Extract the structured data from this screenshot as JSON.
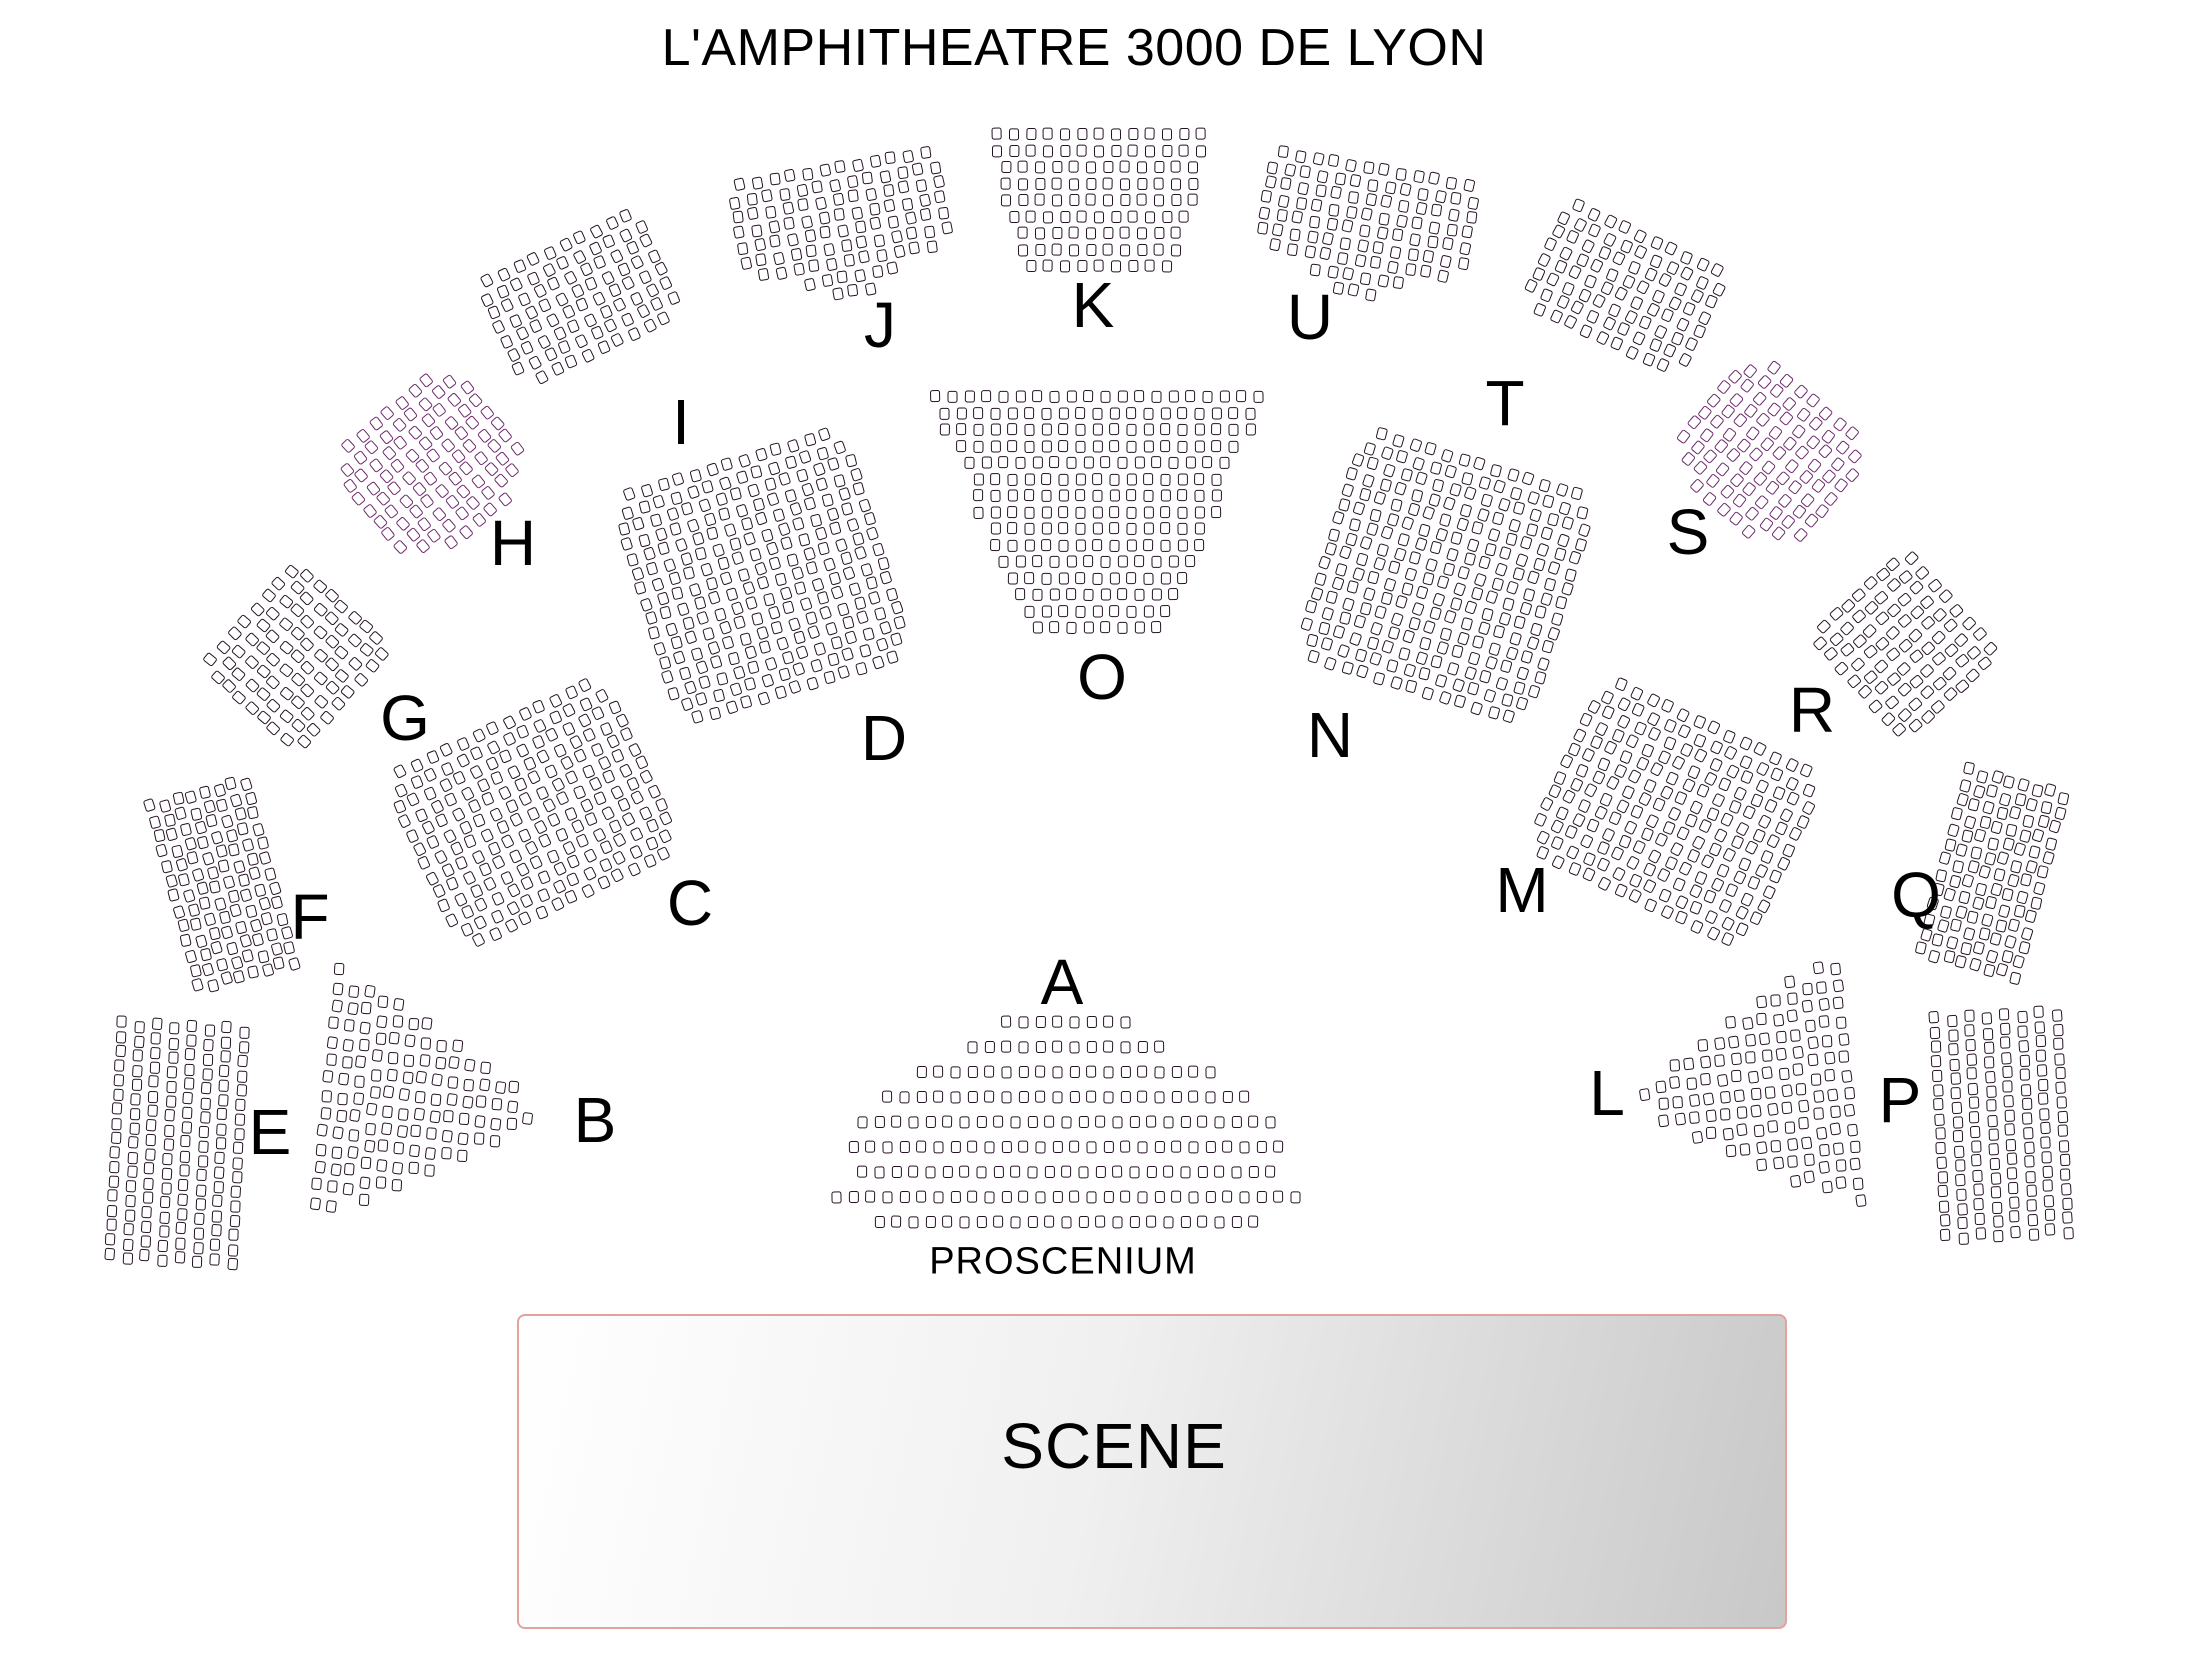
{
  "title": "L'AMPHITHEATRE 3000 DE LYON",
  "title_pos": {
    "x": 1074,
    "y": 18
  },
  "colors": {
    "background": "#ffffff",
    "text": "#000000",
    "seat_fill": "#ffffff",
    "seat_stroke": "#251225",
    "seat_stroke_accent": "#6b286b",
    "stage_border": "#e5a29a",
    "stage_gradient_from": "#ffffff",
    "stage_gradient_to": "#c8c8c8"
  },
  "stage": {
    "label": "SCENE",
    "x": 517,
    "y": 1314,
    "w": 1270,
    "h": 315,
    "label_x": 1114,
    "label_y": 1446
  },
  "proscenium": {
    "label": "PROSCENIUM",
    "x": 1063,
    "y": 1262
  },
  "seat_defaults": {
    "col_gap": 7,
    "row_gap": 3.5
  },
  "sections": [
    {
      "id": "A",
      "label": "A",
      "label_x": 1062,
      "label_y": 982,
      "cx": 1066,
      "cy": 1122,
      "rot": 0,
      "row_gap": 13,
      "jitter": 0.4,
      "rows": [
        8,
        12,
        18,
        22,
        25,
        26,
        25,
        28,
        23
      ]
    },
    {
      "id": "B",
      "label": "B",
      "label_x": 595,
      "label_y": 1120,
      "cx": 428,
      "cy": 1097,
      "rot": 6,
      "col_gap": 5.5,
      "row_gap": 6,
      "stagger": 5,
      "cols": [
        14,
        13,
        12,
        12,
        11,
        10,
        9,
        8,
        7,
        6,
        5,
        4,
        3,
        1
      ]
    },
    {
      "id": "C",
      "label": "C",
      "label_x": 690,
      "label_y": 903,
      "cx": 533,
      "cy": 813,
      "rot": -25,
      "rows": [
        13,
        14,
        15,
        15,
        15,
        15,
        15,
        15,
        15,
        15,
        15,
        14,
        13
      ]
    },
    {
      "id": "D",
      "label": "D",
      "label_x": 884,
      "label_y": 738,
      "cx": 762,
      "cy": 576,
      "rot": -17,
      "rows": [
        13,
        14,
        15,
        15,
        15,
        15,
        15,
        15,
        15,
        15,
        15,
        15,
        15,
        15,
        14,
        13
      ]
    },
    {
      "id": "E",
      "label": "E",
      "label_x": 270,
      "label_y": 1132,
      "cx": 177,
      "cy": 1141,
      "rot": 3,
      "row_gap": 2.5,
      "col_gap": 7.5,
      "stagger": 4,
      "jitter": 0.4,
      "rows": [
        8,
        8,
        8,
        8,
        8,
        8,
        8,
        8,
        8,
        8,
        8,
        8,
        8,
        8,
        8,
        8,
        8
      ]
    },
    {
      "id": "F",
      "label": "F",
      "label_x": 310,
      "label_y": 917,
      "cx": 222,
      "cy": 883,
      "rot": -15,
      "col_gap": 4,
      "stagger": 3,
      "rows": [
        8,
        8,
        8,
        8,
        8,
        8,
        8,
        8,
        8,
        8,
        8,
        8,
        8
      ]
    },
    {
      "id": "G",
      "label": "G",
      "label_x": 405,
      "label_y": 718,
      "cx": 297,
      "cy": 657,
      "rot": -48,
      "rows": [
        8,
        9,
        9,
        9,
        9,
        9,
        9,
        9,
        8
      ]
    },
    {
      "id": "H",
      "label": "H",
      "label_x": 513,
      "label_y": 543,
      "cx": 433,
      "cy": 467,
      "rot": -40,
      "stroke": "#6b286b",
      "rows": [
        7,
        9,
        10,
        10,
        10,
        10,
        10,
        10,
        8,
        5
      ]
    },
    {
      "id": "I",
      "label": "I",
      "label_x": 681,
      "label_y": 422,
      "cx": 580,
      "cy": 298,
      "rot": -25,
      "rows": [
        10,
        11,
        11,
        11,
        11,
        11,
        11,
        9
      ]
    },
    {
      "id": "J",
      "label": "J",
      "label_x": 880,
      "label_y": 325,
      "cx": 843,
      "cy": 230,
      "rot": -10,
      "rows": [
        12,
        13,
        13,
        13,
        13,
        13,
        11,
        6,
        3
      ]
    },
    {
      "id": "K",
      "label": "K",
      "label_x": 1093,
      "label_y": 305,
      "cx": 1099,
      "cy": 200,
      "rot": 0,
      "row_gap": 4.5,
      "jitter": 0.4,
      "rows": [
        13,
        13,
        12,
        12,
        12,
        11,
        10,
        10,
        9
      ]
    },
    {
      "id": "L",
      "label": "L",
      "label_x": 1607,
      "label_y": 1093,
      "cx": 1746,
      "cy": 1085,
      "rot": -6,
      "col_gap": 5.5,
      "row_gap": 6,
      "stagger": 5,
      "cols": [
        1,
        3,
        4,
        5,
        6,
        7,
        8,
        9,
        10,
        11,
        12,
        12,
        13,
        14
      ]
    },
    {
      "id": "M",
      "label": "M",
      "label_x": 1522,
      "label_y": 890,
      "cx": 1675,
      "cy": 813,
      "rot": 25,
      "rows": [
        13,
        14,
        15,
        15,
        15,
        15,
        15,
        15,
        15,
        15,
        15,
        14,
        13
      ]
    },
    {
      "id": "N",
      "label": "N",
      "label_x": 1330,
      "label_y": 735,
      "cx": 1446,
      "cy": 576,
      "rot": 17,
      "rows": [
        13,
        14,
        15,
        15,
        15,
        15,
        15,
        15,
        15,
        15,
        15,
        15,
        15,
        15,
        14,
        13
      ]
    },
    {
      "id": "O",
      "label": "O",
      "label_x": 1102,
      "label_y": 677,
      "cx": 1097,
      "cy": 512,
      "rot": 0,
      "row_gap": 4.5,
      "jitter": 0.4,
      "rows": [
        20,
        19,
        19,
        17,
        16,
        15,
        15,
        15,
        13,
        13,
        12,
        11,
        10,
        9,
        8
      ]
    },
    {
      "id": "P",
      "label": "P",
      "label_x": 1900,
      "label_y": 1100,
      "cx": 2001,
      "cy": 1123,
      "rot": -3,
      "row_gap": 2.5,
      "col_gap": 7.5,
      "stagger": 4,
      "jitter": 0.4,
      "rows": [
        8,
        8,
        8,
        8,
        8,
        8,
        8,
        8,
        8,
        8,
        8,
        8,
        8,
        8,
        8,
        8
      ]
    },
    {
      "id": "Q",
      "label": "Q",
      "label_x": 1916,
      "label_y": 895,
      "cx": 1993,
      "cy": 872,
      "rot": 15,
      "col_gap": 4,
      "stagger": 3,
      "rows": [
        8,
        8,
        8,
        8,
        8,
        8,
        8,
        8,
        8,
        8,
        8,
        8,
        8
      ]
    },
    {
      "id": "R",
      "label": "R",
      "label_x": 1812,
      "label_y": 710,
      "cx": 1905,
      "cy": 645,
      "rot": 48,
      "rows": [
        8,
        9,
        9,
        9,
        9,
        9,
        9,
        9,
        8
      ]
    },
    {
      "id": "S",
      "label": "S",
      "label_x": 1688,
      "label_y": 532,
      "cx": 1768,
      "cy": 455,
      "rot": 40,
      "stroke": "#6b286b",
      "rows": [
        7,
        9,
        10,
        10,
        10,
        10,
        10,
        10,
        8,
        5
      ]
    },
    {
      "id": "T",
      "label": "T",
      "label_x": 1505,
      "label_y": 403,
      "cx": 1625,
      "cy": 288,
      "rot": 25,
      "rows": [
        10,
        11,
        11,
        11,
        11,
        11,
        11,
        9
      ]
    },
    {
      "id": "U",
      "label": "U",
      "label_x": 1310,
      "label_y": 317,
      "cx": 1365,
      "cy": 230,
      "rot": 10,
      "rows": [
        12,
        13,
        13,
        13,
        13,
        13,
        11,
        6,
        3
      ]
    }
  ]
}
